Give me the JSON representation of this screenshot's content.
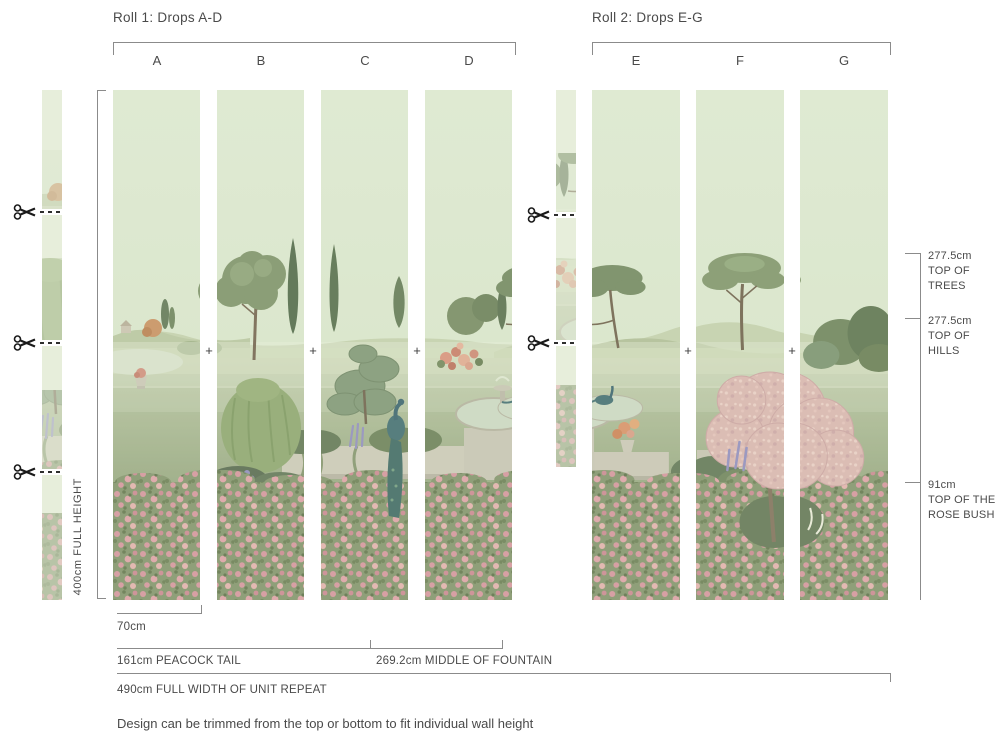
{
  "rolls": [
    {
      "title": "Roll 1: Drops A-D",
      "drops": [
        "A",
        "B",
        "C",
        "D"
      ]
    },
    {
      "title": "Roll 2: Drops E-G",
      "drops": [
        "E",
        "F",
        "G"
      ]
    }
  ],
  "height_ruler": {
    "label": "400cm FULL HEIGHT"
  },
  "alignment_mark": "+",
  "right_annotations": [
    {
      "value": "277.5cm",
      "label": "TOP OF TREES"
    },
    {
      "value": "277.5cm",
      "label": "TOP OF HILLS"
    },
    {
      "value": "91cm",
      "label": "TOP OF THE ROSE BUSH"
    }
  ],
  "bottom_measurements": {
    "drop_width": {
      "value": "70cm"
    },
    "peacock_tail": {
      "value": "161cm",
      "label": "PEACOCK TAIL"
    },
    "fountain": {
      "value": "269.2cm",
      "label": "MIDDLE OF FOUNTAIN"
    },
    "unit_repeat": {
      "value": "490cm",
      "label": "FULL WIDTH OF UNIT REPEAT"
    }
  },
  "footnote": "Design can be trimmed from the top or bottom to fit individual wall height",
  "colors": {
    "sky": "#d9e5cb",
    "rose_band": "#7f9168",
    "text": "#4a4a4a",
    "line": "#8b8b8b",
    "peacock": "#3e6a6e",
    "blossom": "#d9b4ad"
  }
}
